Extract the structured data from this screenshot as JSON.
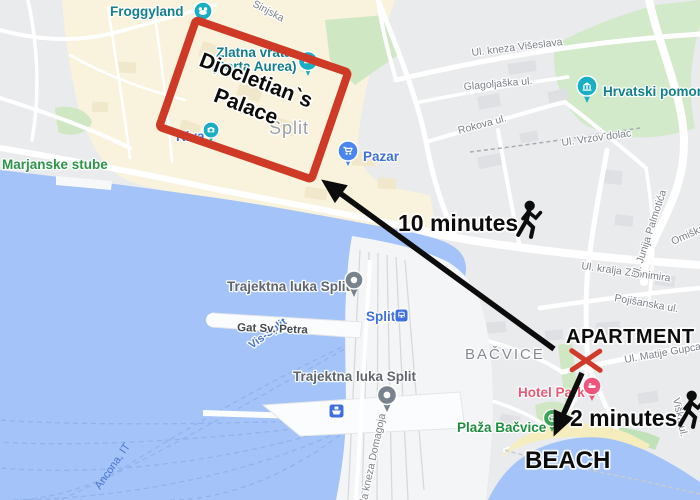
{
  "annotations": {
    "palace_line1": "Diocletian`s",
    "palace_line2": "Palace",
    "walk_palace": "10 minutes",
    "apartment": "APARTMENT",
    "walk_beach": "2 minutes",
    "beach": "BEACH"
  },
  "areas": {
    "old_town": "Split",
    "bacvice": "BAČVICE"
  },
  "pois": {
    "froggyland": {
      "label": "Froggyland"
    },
    "zlatna_vrata": {
      "line1": "Zlatna vrata",
      "line2": "(Porta Aurea)"
    },
    "riva": {
      "label": "Riva"
    },
    "pazar": {
      "label": "Pazar"
    },
    "maritime_museum": {
      "label": "Hrvatski pomors"
    },
    "marjanske_stube": {
      "label": "Marjanske stube"
    },
    "hotel_park": {
      "label": "Hotel Park"
    },
    "plaza_bacvice": {
      "label": "Plaža Bačvice"
    },
    "ferry_port_1": {
      "label": "Trajektna luka Split"
    },
    "ferry_port_2": {
      "label": "Trajektna luka Split"
    },
    "split_station": {
      "label": "Split"
    },
    "gat_sv_petra": {
      "label": "Gat Sv. Petra"
    }
  },
  "streets": {
    "sinjska": "Sinjska",
    "kneza_viseslava": "Ul. kneza Višeslava",
    "glagoljaska": "Glagoljaška ul.",
    "rokova": "Rokova ul.",
    "vrzov_dolac": "Ul. Vrzov dolac",
    "kralja_zvonimira": "Ul. kralja Zvonimira",
    "pojisanska": "Pojišanska ul.",
    "junija_palmotica": "Ul. Junija Palmotića",
    "omiska": "Omiška",
    "matije_gupca": "Ul. Matije Gupca",
    "viska": "Viška ul.",
    "obala_kneza_domagoja": "Obala kneza Domagoja"
  },
  "ferry_routes": {
    "vis": "Vis-Split",
    "ancona": "Ancona, IT"
  },
  "colors": {
    "water": "#A4C3F8",
    "land": "#EAEBED",
    "old_town": "#F9F2DC",
    "park": "#CFE7C3",
    "sand": "#F6EDBE",
    "road": "#FFFFFF",
    "annotation_red": "#CE3A26",
    "annotation_black": "#111111",
    "poi_teal": "#11808D",
    "transit_blue": "#3F70DE",
    "hotel_pink": "#EA5A76",
    "park_green_label": "#2E9549",
    "area_gray": "#9AA0A6",
    "street_gray": "#80858B",
    "ferry_blue": "#4A76CC"
  }
}
